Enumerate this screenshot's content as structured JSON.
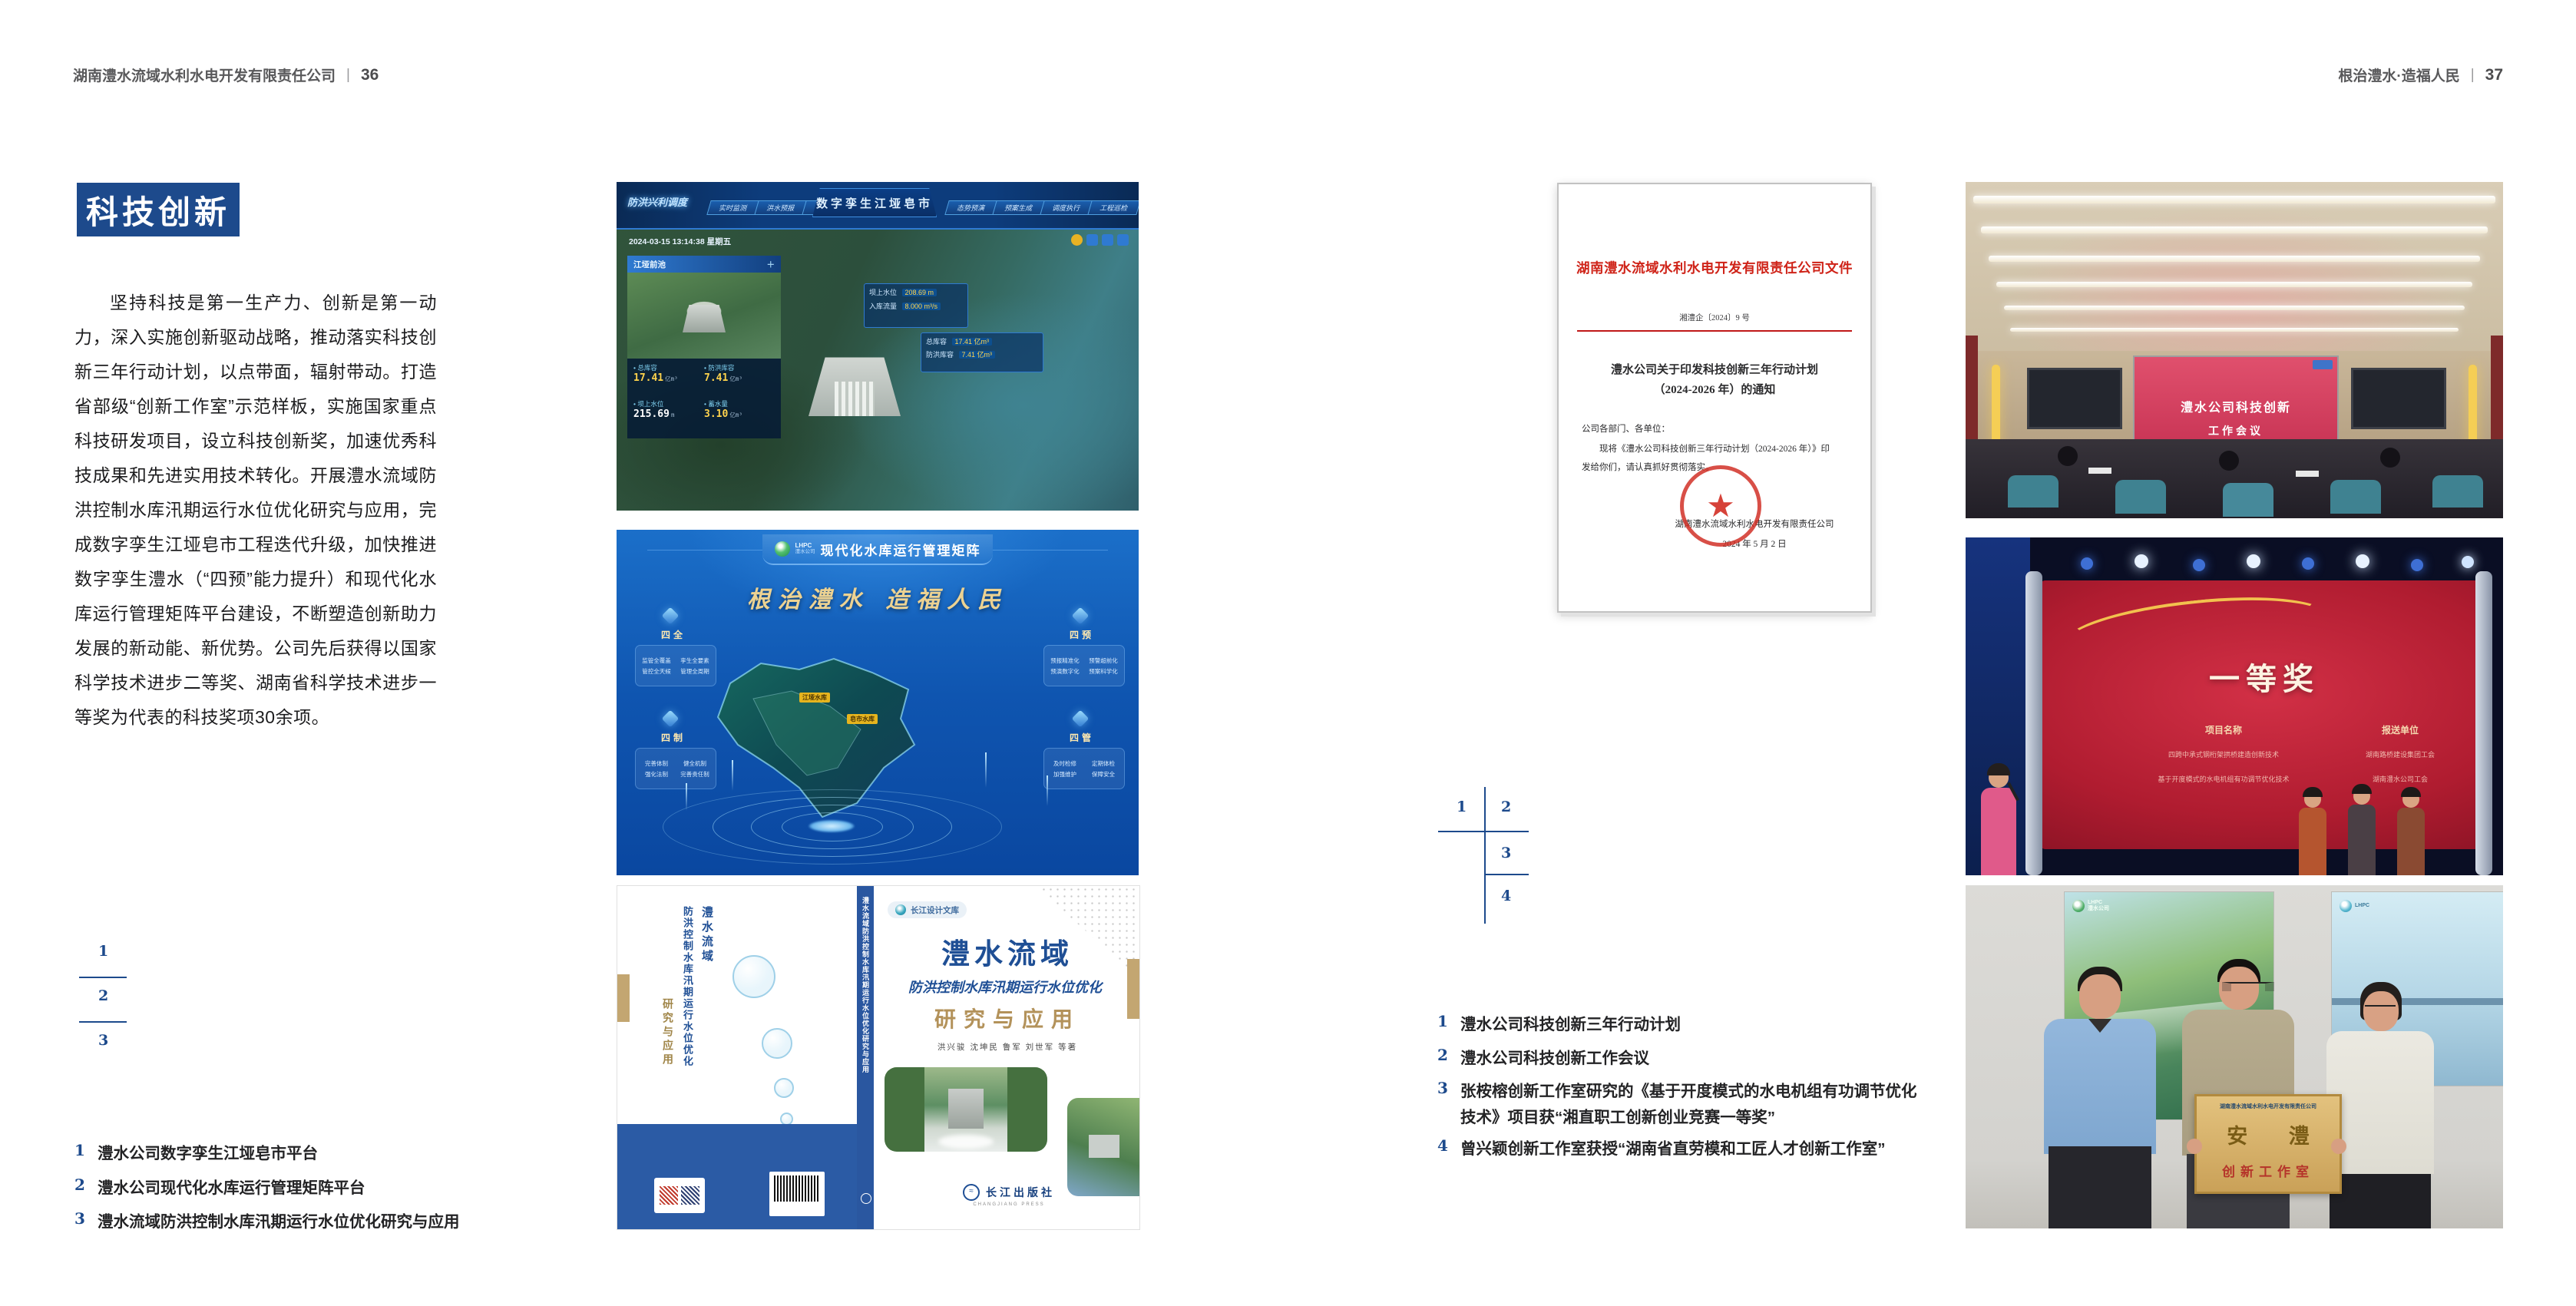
{
  "colors": {
    "accent_blue": "#1d4a8c",
    "doc_red": "#cf2318",
    "gold_khaki": "#c3a671",
    "page_bg": "#ffffff"
  },
  "page_left": {
    "header": {
      "company": "湖南澧水流域水利水电开发有限责任公司",
      "sep": "|",
      "page": "36"
    },
    "badge": "科技创新",
    "paragraph": "坚持科技是第一生产力、创新是第一动力，深入实施创新驱动战略，推动落实科技创新三年行动计划，以点带面，辐射带动。打造省部级“创新工作室”示范样板，实施国家重点科技研发项目，设立科技创新奖，加速优秀科技成果和先进实用技术转化。开展澧水流域防洪控制水库汛期运行水位优化研究与应用，完成数字孪生江垭皂市工程迭代升级，加快推进数字孪生澧水（“四预”能力提升）和现代化水库运行管理矩阵平台建设，不断塑造创新助力发展的新动能、新优势。公司先后获得以国家科学技术进步二等奖、湖南省科学技术进步一等奖为代表的科技奖项30余项。",
    "index_numbers": [
      "1",
      "2",
      "3"
    ],
    "captions": [
      {
        "n": "1",
        "t": "澧水公司数字孪生江垭皂市平台"
      },
      {
        "n": "2",
        "t": "澧水公司现代化水库运行管理矩阵平台"
      },
      {
        "n": "3",
        "t": "澧水流域防洪控制水库汛期运行水位优化研究与应用"
      }
    ],
    "fig_dashboard": {
      "corner": "防洪兴利调度",
      "tabs_left": [
        "实时监测",
        "洪水预报",
        "防汛预警"
      ],
      "title": "数字孪生江垭皂市",
      "tabs_right": [
        "态势预演",
        "预案生成",
        "调度执行",
        "工程巡检"
      ],
      "datetime": "2024-03-15 13:14:38 星期五",
      "panel_title": "江垭前池",
      "stats": [
        {
          "l": "总库容",
          "v": "17.41",
          "u": "亿m³"
        },
        {
          "l": "防洪库容",
          "v": "7.41",
          "u": "亿m³"
        },
        {
          "l": "坝上水位",
          "v": "215.69",
          "u": "m"
        },
        {
          "l": "蓄水量",
          "v": "3.10",
          "u": "亿m³"
        }
      ],
      "chip1_l": "坝上水位",
      "chip1_v": "208.69 m",
      "chip2_l": "入库流量",
      "chip2_v": "8.000 m³/s",
      "chip3_l": "总库容",
      "chip3_v": "17.41 亿m³",
      "chip4_l": "防洪库容",
      "chip4_v": "7.41 亿m³"
    },
    "fig_matrix": {
      "logo": "LHPC",
      "logo_sub": "澧水公司",
      "title": "现代化水库运行管理矩阵",
      "slogan": "根治澧水 造福人民",
      "panels": [
        {
          "name": "四全",
          "items": [
            "监管全覆盖",
            "孪生全要素",
            "管控全天候",
            "管理全周期"
          ]
        },
        {
          "name": "四预",
          "items": [
            "预报精准化",
            "预警超前化",
            "预演数字化",
            "预案科学化"
          ]
        },
        {
          "name": "四制",
          "items": [
            "完善体制",
            "健全机制",
            "强化法制",
            "完善责任制"
          ]
        },
        {
          "name": "四管",
          "items": [
            "及时检修",
            "定期体检",
            "加强维护",
            "保障安全"
          ]
        }
      ],
      "map_label1": "江垭水库",
      "map_label2": "皂市水库"
    },
    "fig_book": {
      "series": "长江设计文库",
      "title1": "澧水流域",
      "title2": "防洪控制水库汛期运行水位优化",
      "title3": "研究与应用",
      "authors": "洪兴骏 沈坤民 鲁军 刘世军 等著",
      "spine": "澧水流域防洪控制水库汛期运行水位优化研究与应用",
      "publisher": "长江出版社",
      "publisher_en": "CHANGJIANG PRESS"
    }
  },
  "page_right": {
    "header": {
      "company": "根治澧水·造福人民",
      "sep": "|",
      "page": "37"
    },
    "document": {
      "red_title": "湖南澧水流域水利水电开发有限责任公司文件",
      "doc_no": "湘澧企〔2024〕9 号",
      "title_l1": "澧水公司关于印发科技创新三年行动计划",
      "title_l2": "（2024-2026 年）的通知",
      "salutation": "公司各部门、各单位：",
      "body_l1": "现将《澧水公司科技创新三年行动计划（2024-2026 年）》印",
      "body_l2": "发给你们，请认真抓好贯彻落实。",
      "signer": "湖南澧水流域水利水电开发有限责任公司",
      "date": "2024 年 5 月 2 日"
    },
    "index_numbers": [
      "1",
      "2",
      "3",
      "4"
    ],
    "captions": [
      {
        "n": "1",
        "t": "澧水公司科技创新三年行动计划"
      },
      {
        "n": "2",
        "t": "澧水公司科技创新工作会议"
      },
      {
        "n": "3",
        "t": "张桉榕创新工作室研究的《基于开度模式的水电机组有功调节优化技术》项目获“湘直职工创新创业竞赛一等奖”"
      },
      {
        "n": "4",
        "t": "曾兴颖创新工作室获授“湖南省直劳模和工匠人才创新工作室”"
      }
    ],
    "photo_meeting": {
      "screen_l1": "澧水公司科技创新",
      "screen_l2": "工作会议"
    },
    "photo_award": {
      "title": "一等奖",
      "col1": "项目名称",
      "col2": "报送单位",
      "row1_p": "四跨中承式钢桁架拱桥建造创新技术",
      "row1_u": "湖南路桥建设集团工会",
      "row2_p": "基于开度模式的水电机组有功调节优化技术",
      "row2_u": "湖南澧水公司工会"
    },
    "photo_group": {
      "plaque_org": "湖南澧水流域水利水电开发有限责任公司",
      "plaque_main": "安 澧",
      "plaque_sub": "创新工作室",
      "poster_logo": "LHPC",
      "poster_logo_sub": "澧水公司"
    }
  }
}
